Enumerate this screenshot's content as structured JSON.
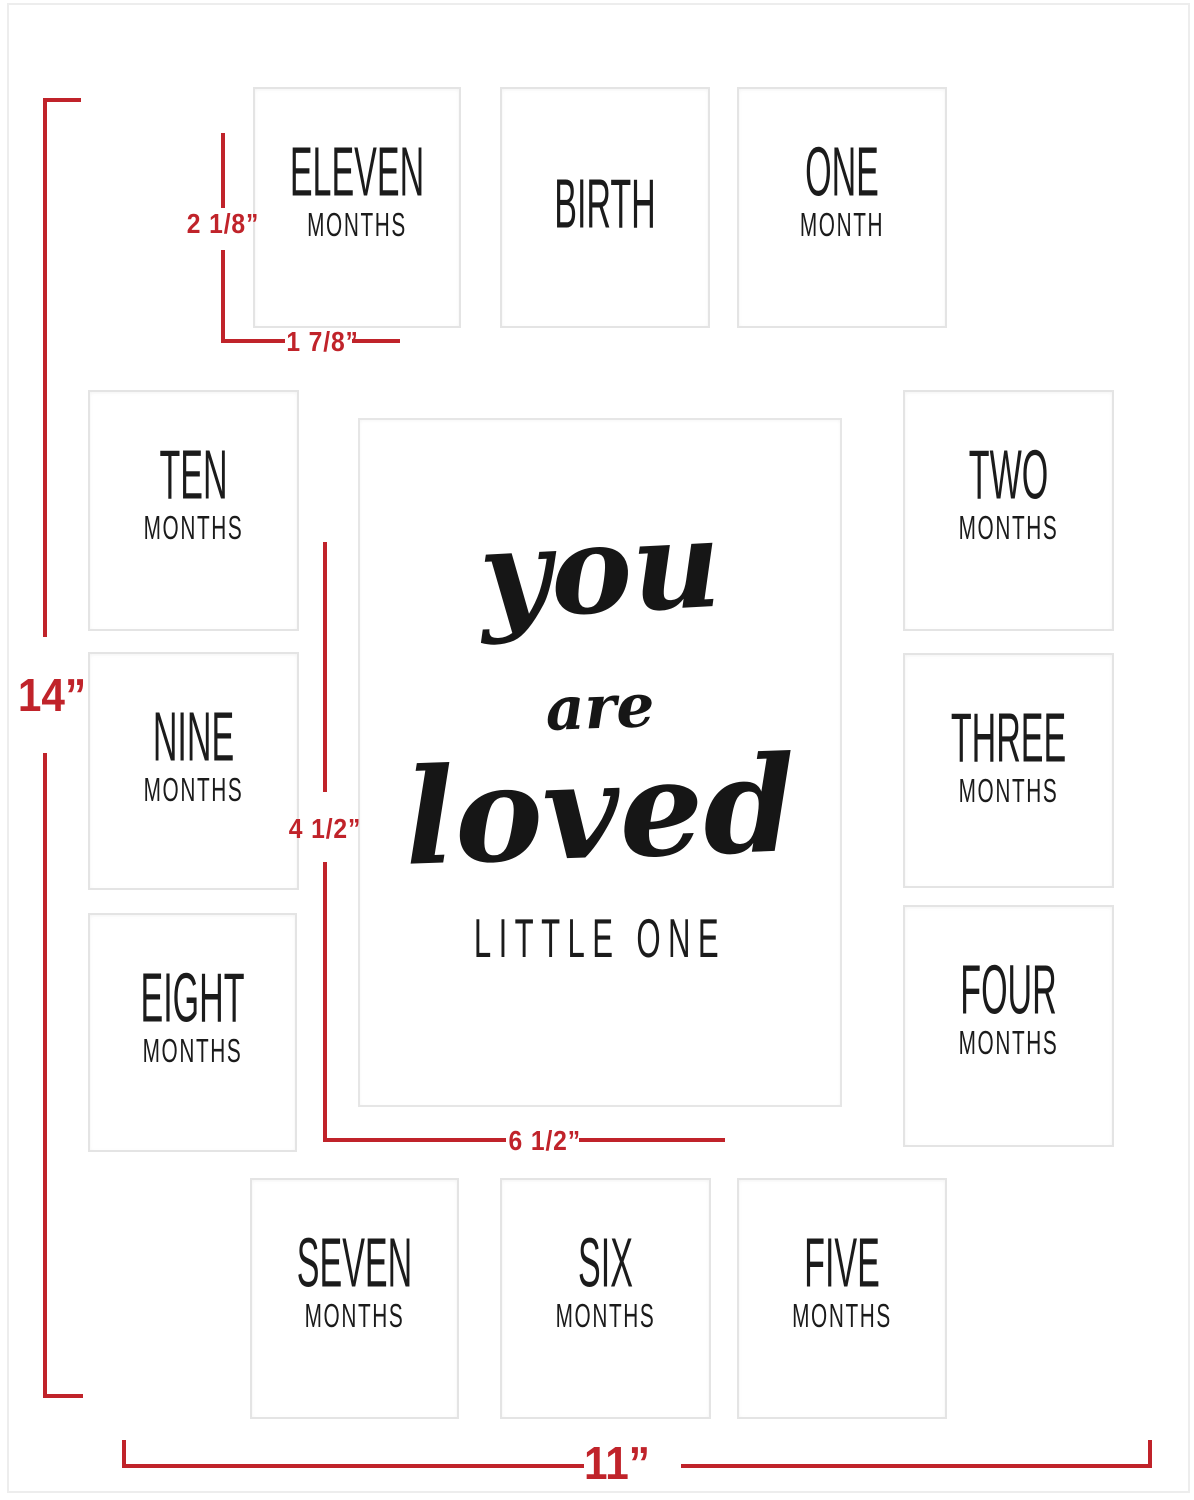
{
  "product": {
    "type": "baby milestone picture mat diagram",
    "colors": {
      "accent_red": "#c0232a",
      "opening_border": "#e4e4e4",
      "mat_edge": "#ededed",
      "text_black": "#1b1b1b"
    }
  },
  "openings": [
    {
      "name": "eleven-months",
      "line1": "ELEVEN",
      "line2": "MONTHS"
    },
    {
      "name": "birth",
      "line1": "BIRTH",
      "line2": ""
    },
    {
      "name": "one-month",
      "line1": "ONE",
      "line2": "MONTH"
    },
    {
      "name": "ten-months",
      "line1": "TEN",
      "line2": "MONTHS"
    },
    {
      "name": "two-months",
      "line1": "TWO",
      "line2": "MONTHS"
    },
    {
      "name": "nine-months",
      "line1": "NINE",
      "line2": "MONTHS"
    },
    {
      "name": "three-months",
      "line1": "THREE",
      "line2": "MONTHS"
    },
    {
      "name": "eight-months",
      "line1": "EIGHT",
      "line2": "MONTHS"
    },
    {
      "name": "four-months",
      "line1": "FOUR",
      "line2": "MONTHS"
    },
    {
      "name": "seven-months",
      "line1": "SEVEN",
      "line2": "MONTHS"
    },
    {
      "name": "six-months",
      "line1": "SIX",
      "line2": "MONTHS"
    },
    {
      "name": "five-months",
      "line1": "FIVE",
      "line2": "MONTHS"
    }
  ],
  "center": {
    "word1": "you",
    "word2": "are",
    "word3": "loved",
    "subtitle": "LITTLE ONE"
  },
  "dimensions": {
    "opening_height": "2 1/8”",
    "opening_width": "1 7/8”",
    "total_height": "14”",
    "center_height": "4 1/2”",
    "center_width": "6 1/2”",
    "total_width": "11”"
  }
}
